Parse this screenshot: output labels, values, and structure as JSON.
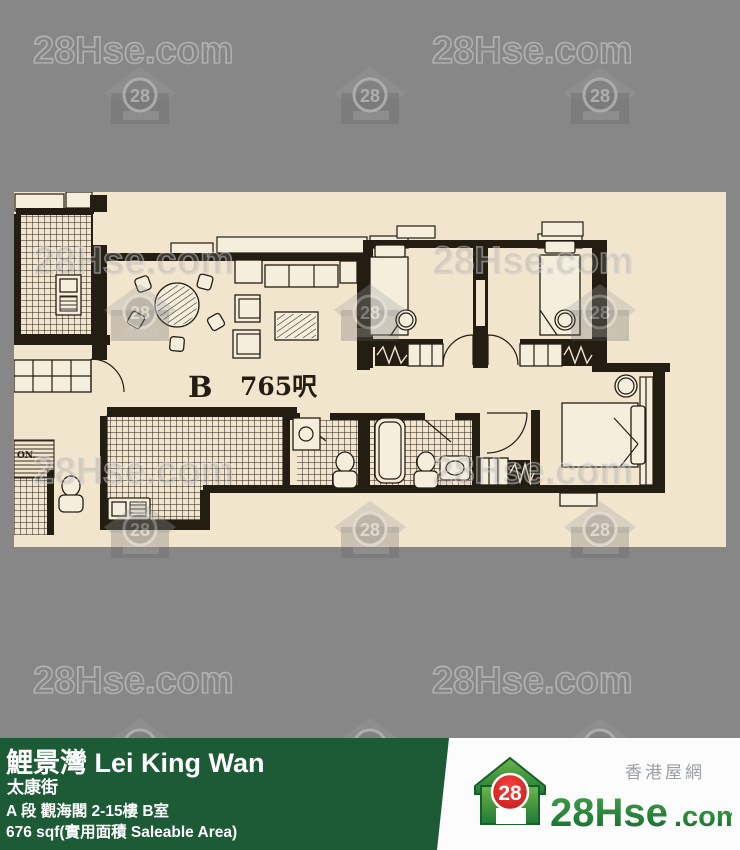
{
  "watermark": {
    "label": "28Hse.com",
    "badge": "28"
  },
  "floorplan": {
    "unit": "B",
    "area": "765呎",
    "corner": "ON.",
    "paper_color": "#f2e5cd",
    "ink_color": "#241d12"
  },
  "footer": {
    "title": "鯉景灣 Lei King Wan",
    "street": "太康街",
    "address": "A 段 觀海閣 2-15樓 B室",
    "area": "676 sqf(實用面積 Saleable Area)",
    "green_color": "#1d5b36",
    "logo": {
      "badge": "28",
      "site": "28Hse",
      "suffix": ".com",
      "tagline": "香港屋網",
      "red_color": "#e01f26",
      "green_color": "#1e7a35"
    }
  },
  "background_color": "#878787"
}
